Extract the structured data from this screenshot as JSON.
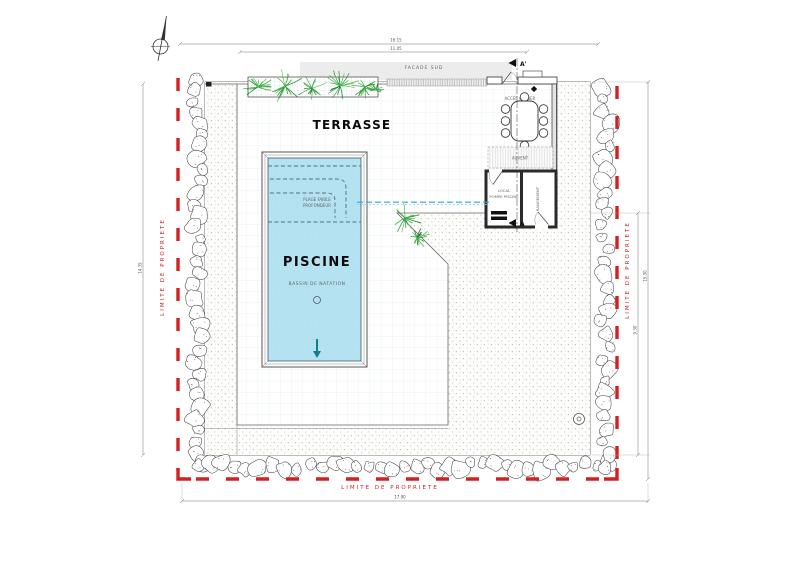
{
  "plan": {
    "labels": {
      "terrasse": "TERRASSE",
      "piscine": "PISCINE",
      "bassin": "BASSIN DE NATATION",
      "plage_1": "PLAGE FAIBLE",
      "plage_2": "PROFONDEUR",
      "facade": "FACADE SUD",
      "acces_cellier": "ACCES CELLIER",
      "auvent": "AUVENT",
      "local_1": "LOCAL",
      "local_2": "POMPE PISCINE",
      "rangement": "RANGEMENT",
      "limite_left": "LIMITE DE PROPRIETE",
      "limite_right": "LIMITE DE PROPRIETE",
      "limite_bottom": "LIMITE DE PROPRIETE",
      "section_top": "A'",
      "section_bottom": "A"
    },
    "dimensions": {
      "top_outer": "16.15",
      "top_inner": "11.05",
      "bottom": "17.90",
      "right_outer": "15.30",
      "right_inner": "9.30",
      "left": "14.35"
    },
    "colors": {
      "boundary_red": "#d42020",
      "pool_water": "#b5e2f0",
      "pipe_blue": "#2fa7d8",
      "vegetation_green": "#2f9e44",
      "arrow_teal": "#157f8d"
    }
  }
}
